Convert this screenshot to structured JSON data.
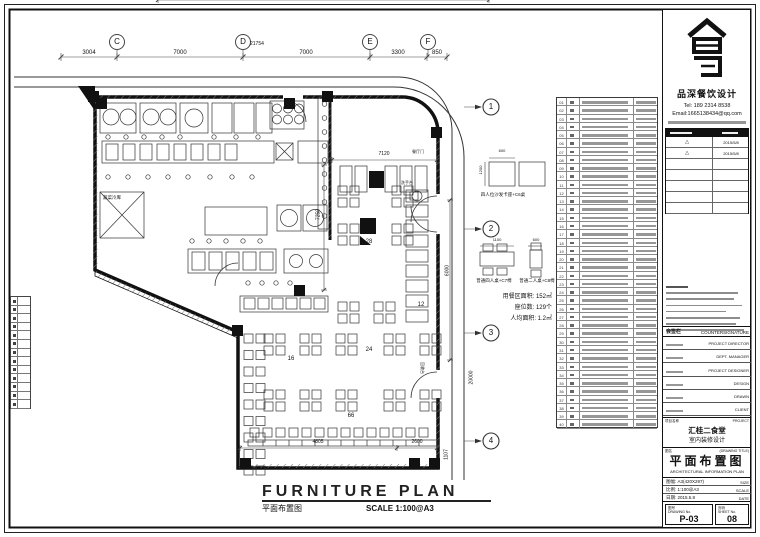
{
  "sheet_title": {
    "en": "FURNITURE PLAN",
    "zh": "平面布置图",
    "scale": "SCALE 1:100@A3"
  },
  "grid_axes": {
    "bubbles": [
      "C",
      "D",
      "E",
      "F"
    ],
    "segments": [
      "3004",
      "7000",
      "7000",
      "3300",
      "850"
    ],
    "overall": "21754"
  },
  "right_axis_bubbles": [
    "1",
    "2",
    "3",
    "4"
  ],
  "plan": {
    "room_labels": {
      "veg_cold_room": "蔬菜冷库",
      "wash_station": "洗手台",
      "recycle_counter": "回收台",
      "dining_door": "餐厅门"
    },
    "seat_counts": {
      "banquette": "28",
      "wash_row": "12",
      "mid": "24",
      "mid_left": "16",
      "bench": "66"
    },
    "dimensions": {
      "top_width": "7120",
      "left_height": "7250",
      "bottom_left": "4805",
      "bottom_right": "2600",
      "right_height": "6000",
      "road": "20000",
      "right_small": "1107"
    },
    "stats": [
      "用餐区面积: 152㎡",
      "座位数: 129个",
      "人均面积: 1.2㎡"
    ],
    "details": [
      {
        "label": "四人位沙发卡座+C6桌",
        "dim_w": "600",
        "dim_h": "1200"
      },
      {
        "label": "普通四人桌+C7椅",
        "dim_w": "1100"
      },
      {
        "label": "普通二人桌+C8椅",
        "dim_w": "600"
      }
    ]
  },
  "schedule": {
    "numbers": [
      "01",
      "02",
      "03",
      "04",
      "05",
      "06",
      "07",
      "08",
      "09",
      "10",
      "11",
      "12",
      "13",
      "14",
      "15",
      "16",
      "17",
      "18",
      "19",
      "20",
      "21",
      "22",
      "23",
      "24",
      "25",
      "26",
      "27",
      "28",
      "29",
      "30",
      "31",
      "32",
      "33",
      "34",
      "35",
      "36",
      "37",
      "38",
      "39",
      "40"
    ]
  },
  "titleblock": {
    "brand": {
      "name": "品深餐饮设计",
      "tel": "Tel: 189 2314 8538",
      "email": "Email:1665138434@qq.com"
    },
    "revisions": [
      {
        "mark": "△",
        "date": "2015/5/8"
      },
      {
        "mark": "△",
        "date": "2015/5/8"
      }
    ],
    "countersign": {
      "zh": "会签栏",
      "en": "COUNTERSIGNATURE"
    },
    "roles": [
      "PROJECT DIRECTOR",
      "DEPT. MANAGER",
      "PROJECT DESIGNER",
      "DESIGN",
      "DRAWN",
      "CLIENT"
    ],
    "project": {
      "zh": "项目名称",
      "en": "PROJECT",
      "line1": "汇桂二食堂",
      "line2": "室内装修设计"
    },
    "drawing": {
      "zh": "图名",
      "en": "(DRAWING TITLE)",
      "title_zh": "平面布置图",
      "title_en": "ARCHITECTURAL INFORMATION PLAN"
    },
    "meta": [
      {
        "zh": "图幅: A3(420X297)",
        "en": "SIZE"
      },
      {
        "zh": "比例: 1:100@A3",
        "en": "SCALE"
      },
      {
        "zh": "日期: 2015.5.8",
        "en": "DATE"
      }
    ],
    "numbers": {
      "dwg_zh": "图号",
      "dwg_en": "DRAWING No.",
      "dwg": "P-03",
      "sheet_zh": "页码",
      "sheet_en": "SHEET No.",
      "sheet": "08"
    }
  }
}
